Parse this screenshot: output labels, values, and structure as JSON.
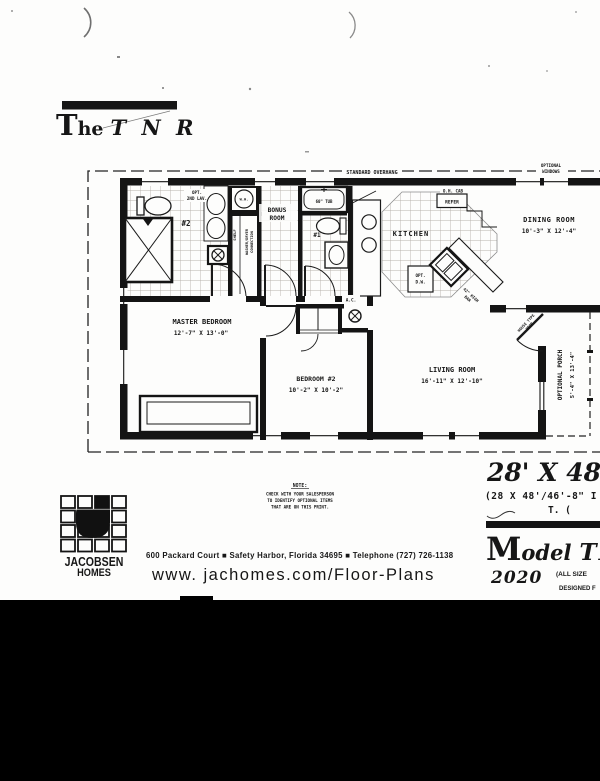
{
  "title": {
    "t": "T",
    "he": "he",
    "name": "T N R"
  },
  "plan": {
    "overhang_label": "STANDARD OVERHANG",
    "optional_windows_1": "OPTIONAL",
    "optional_windows_2": "WINDOWS",
    "rooms": {
      "master": {
        "name": "MASTER BEDROOM",
        "dims": "12'-7\" X 13'-0\""
      },
      "bedroom2": {
        "name": "BEDROOM #2",
        "dims": "10'-2\" X 10'-2\""
      },
      "living": {
        "name": "LIVING ROOM",
        "dims": "16'-11\" X 12'-10\""
      },
      "dining": {
        "name": "DINING ROOM",
        "dims": "10'-3\" X 12'-4\""
      },
      "kitchen": {
        "name": "KITCHEN"
      },
      "bonus_1": "BONUS",
      "bonus_2": "ROOM",
      "porch_name": "OPTIONAL PORCH",
      "porch_dims": "5'-4\" X 13'-4\""
    },
    "labels": {
      "opt_lav_1": "OPT.",
      "opt_lav_2": "2ND LAV.",
      "bath2": "#2",
      "bath1": "#1",
      "wh": "W.H.",
      "shelf": "SHELF",
      "washer_1": "WASHER/DRYER",
      "washer_2": "CONNECTION",
      "tub": "60\" TUB",
      "oh_cab": "O.H. CAB",
      "refer": "REFER",
      "dw_1": "OPT.",
      "dw_2": "D.W.",
      "bar_1": "42\" HIGH",
      "bar_2": "BAR",
      "ac": "A.C.",
      "house_door_1": "HOUSE TYPE",
      "house_door_2": "DOOR"
    }
  },
  "note": {
    "heading": "NOTE:",
    "line1": "CHECK WITH YOUR SALESPERSON",
    "line2": "TO IDENTIFY OPTIONAL ITEMS",
    "line3": "THAT ARE ON THIS PRINT."
  },
  "logo": {
    "name": "JACOBSEN",
    "sub": "HOMES"
  },
  "footer": {
    "address": "600 Packard Court  ■  Safety Harbor, Florida 34695  ■  Telephone (727) 726-1138",
    "website": "www. jachomes.com/Floor-Plans"
  },
  "model_info": {
    "size_large": "28' X 48'/4",
    "size_paren": "(28 X 48'/46'-8\" I",
    "size_t": "T. (",
    "model_m": "M",
    "model_odel": "odel",
    "model_series": "TN",
    "year": "2020",
    "all_sizes": "(ALL SIZE",
    "designed": "DESIGNED F"
  }
}
